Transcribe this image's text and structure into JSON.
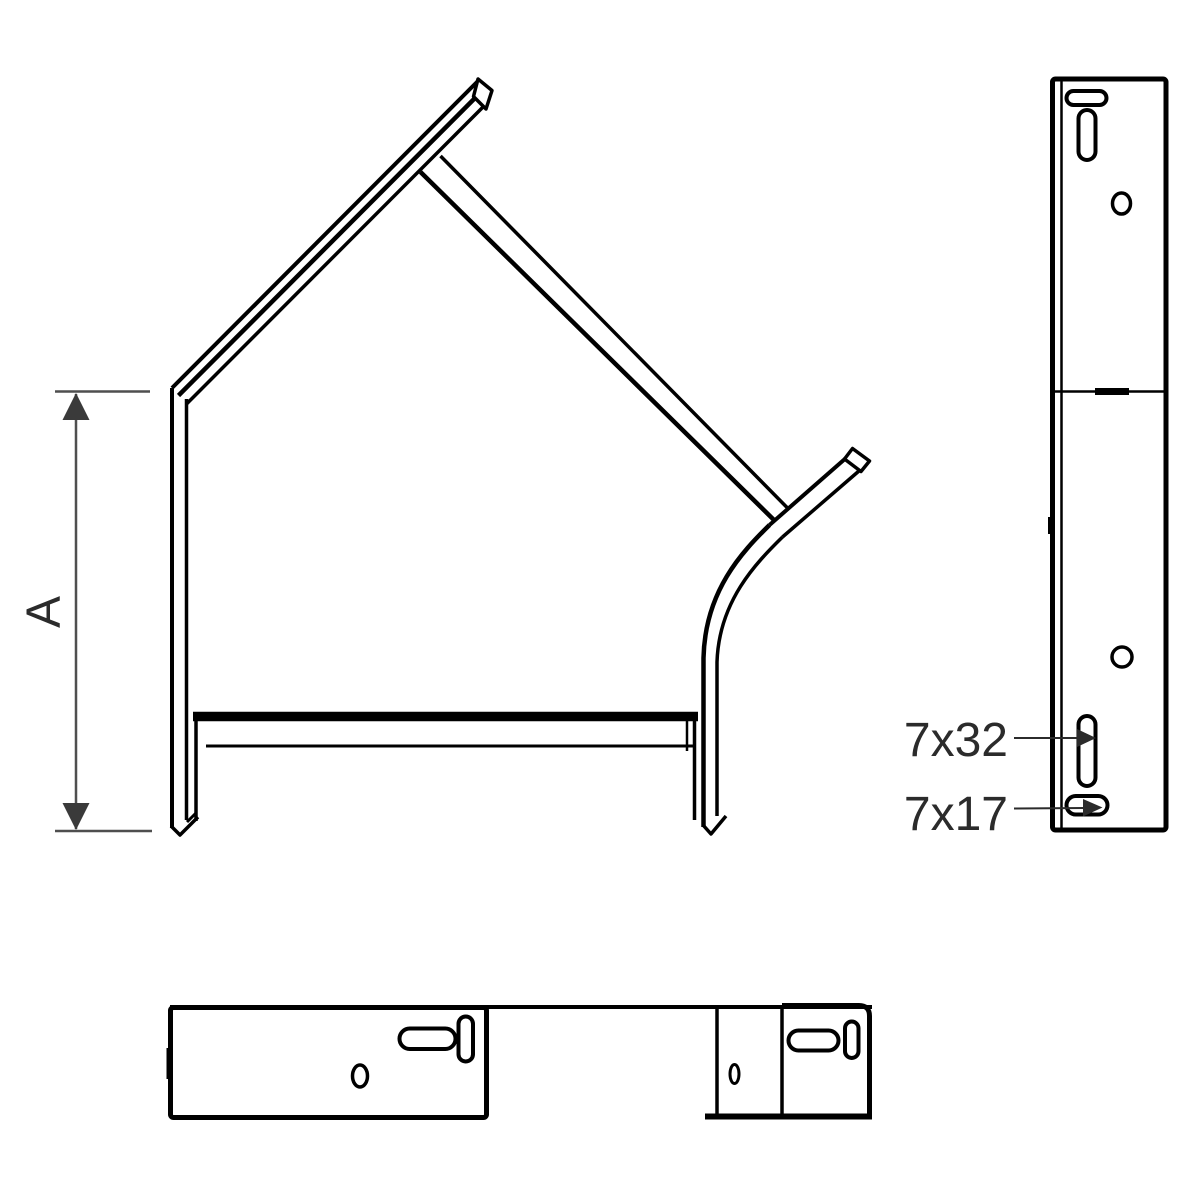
{
  "dimension": {
    "label": "A"
  },
  "annotations": {
    "vertical_slot": "7x32",
    "horizontal_slot": "7x17"
  },
  "colors": {
    "drawing_line": "#000000",
    "dimension_line": "#4f4f4f",
    "arrowhead": "#3a3a3a",
    "label_text": "#2b2b2b",
    "background": "#ffffff"
  }
}
